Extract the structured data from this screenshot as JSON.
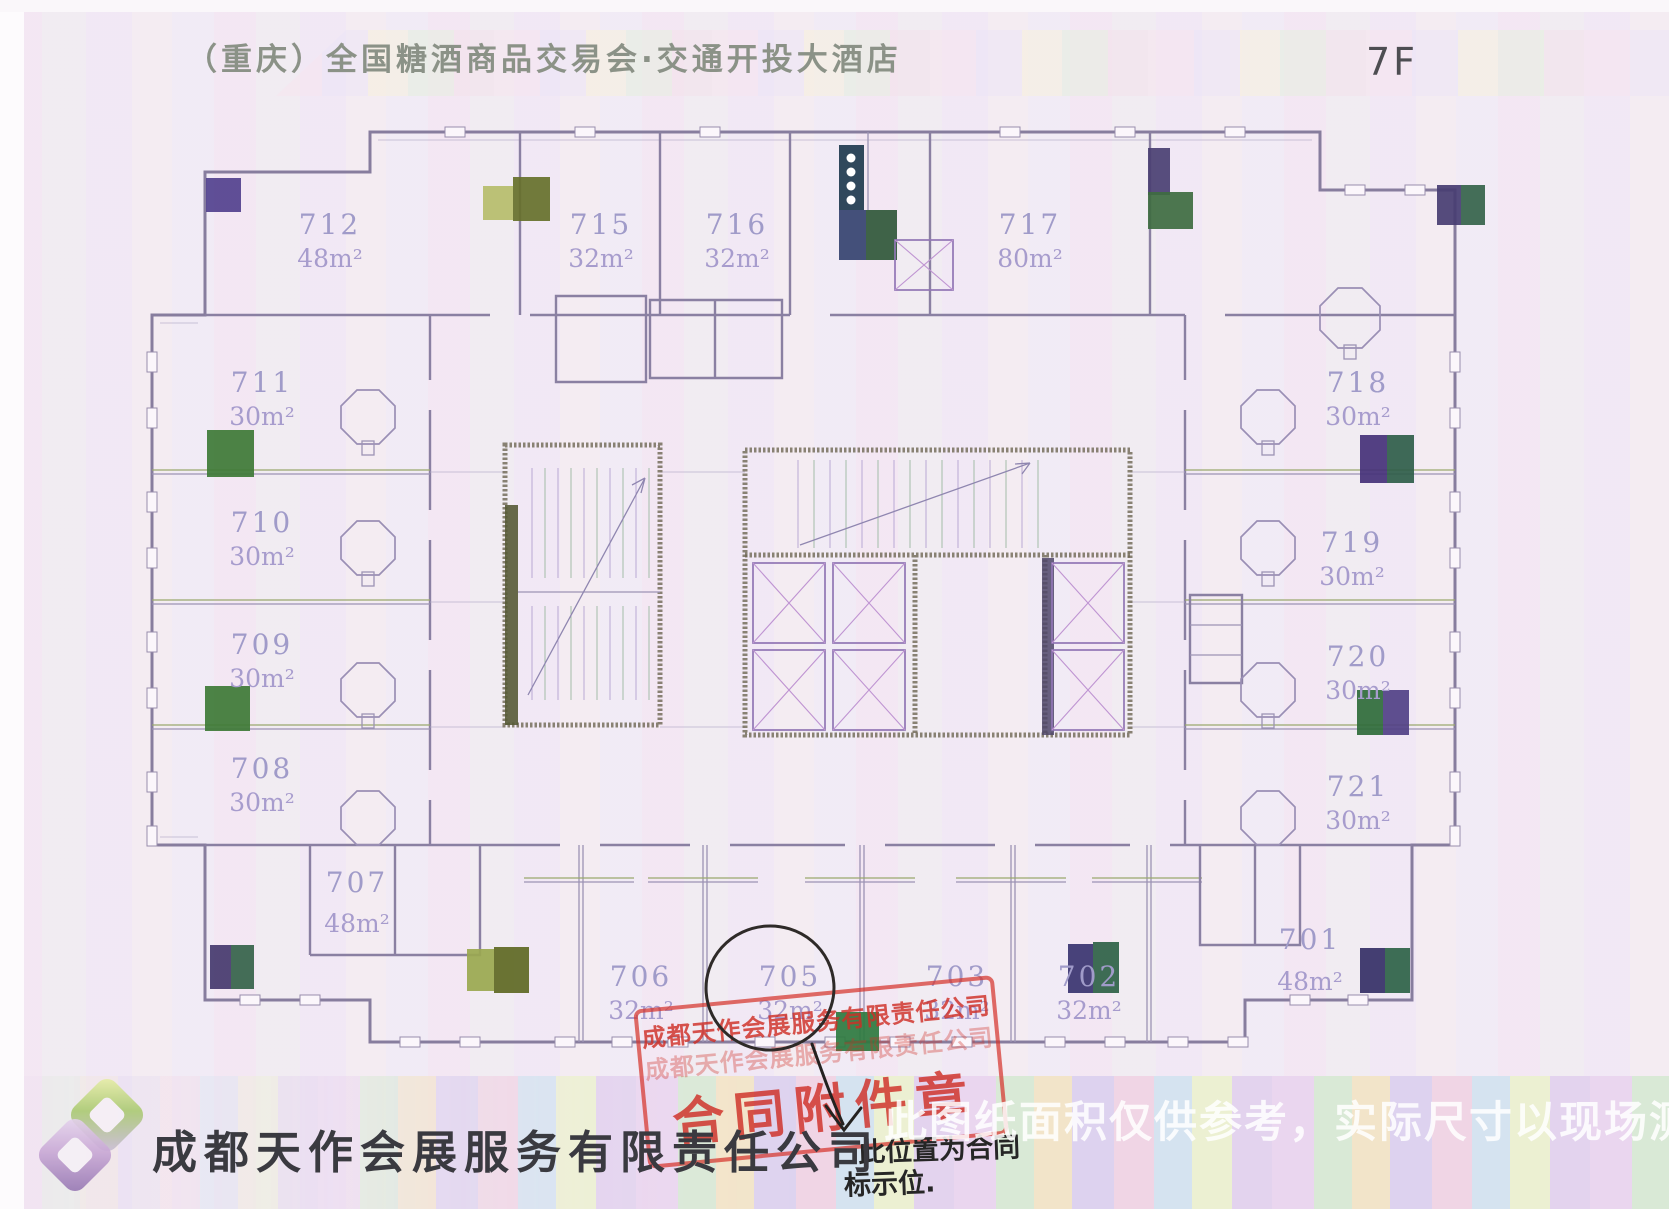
{
  "header": {
    "title": "（重庆）全国糖酒商品交易会·交通开投大酒店",
    "floor_label": "7F"
  },
  "floor_plan": {
    "rooms": [
      {
        "number": "712",
        "area": "48m²"
      },
      {
        "number": "715",
        "area": "32m²"
      },
      {
        "number": "716",
        "area": "32m²"
      },
      {
        "number": "717",
        "area": "80m²"
      },
      {
        "number": "711",
        "area": "30m²"
      },
      {
        "number": "710",
        "area": "30m²"
      },
      {
        "number": "709",
        "area": "30m²"
      },
      {
        "number": "708",
        "area": "30m²"
      },
      {
        "number": "718",
        "area": "30m²"
      },
      {
        "number": "719",
        "area": "30m²"
      },
      {
        "number": "720",
        "area": "30m²"
      },
      {
        "number": "721",
        "area": "30m²"
      },
      {
        "number": "707",
        "area": "48m²"
      },
      {
        "number": "706",
        "area": "32m²"
      },
      {
        "number": "705",
        "area": "32m²"
      },
      {
        "number": "703",
        "area": "32m²"
      },
      {
        "number": "702",
        "area": "32m²"
      },
      {
        "number": "701",
        "area": "48m²"
      }
    ],
    "annotated_room": "705"
  },
  "stamp": {
    "company_line": "成都天作会展服务有限责任公司",
    "seal_line": "合同附件章"
  },
  "handwriting": {
    "line1": "此位置为合同",
    "line2": "标示位."
  },
  "footer": {
    "company": "成都天作会展服务有限责任公司"
  },
  "watermark": {
    "text": "此图纸面积仅供参考，实际尺寸以现场测量为准"
  },
  "colors": {
    "stamp_red": "#d93a32",
    "label_purple": "#a29dca",
    "plan_line": "#8a80a0",
    "marker_green": "#3e7a36",
    "marker_purple": "#4a3f72",
    "paper": "#f4ecf6"
  }
}
